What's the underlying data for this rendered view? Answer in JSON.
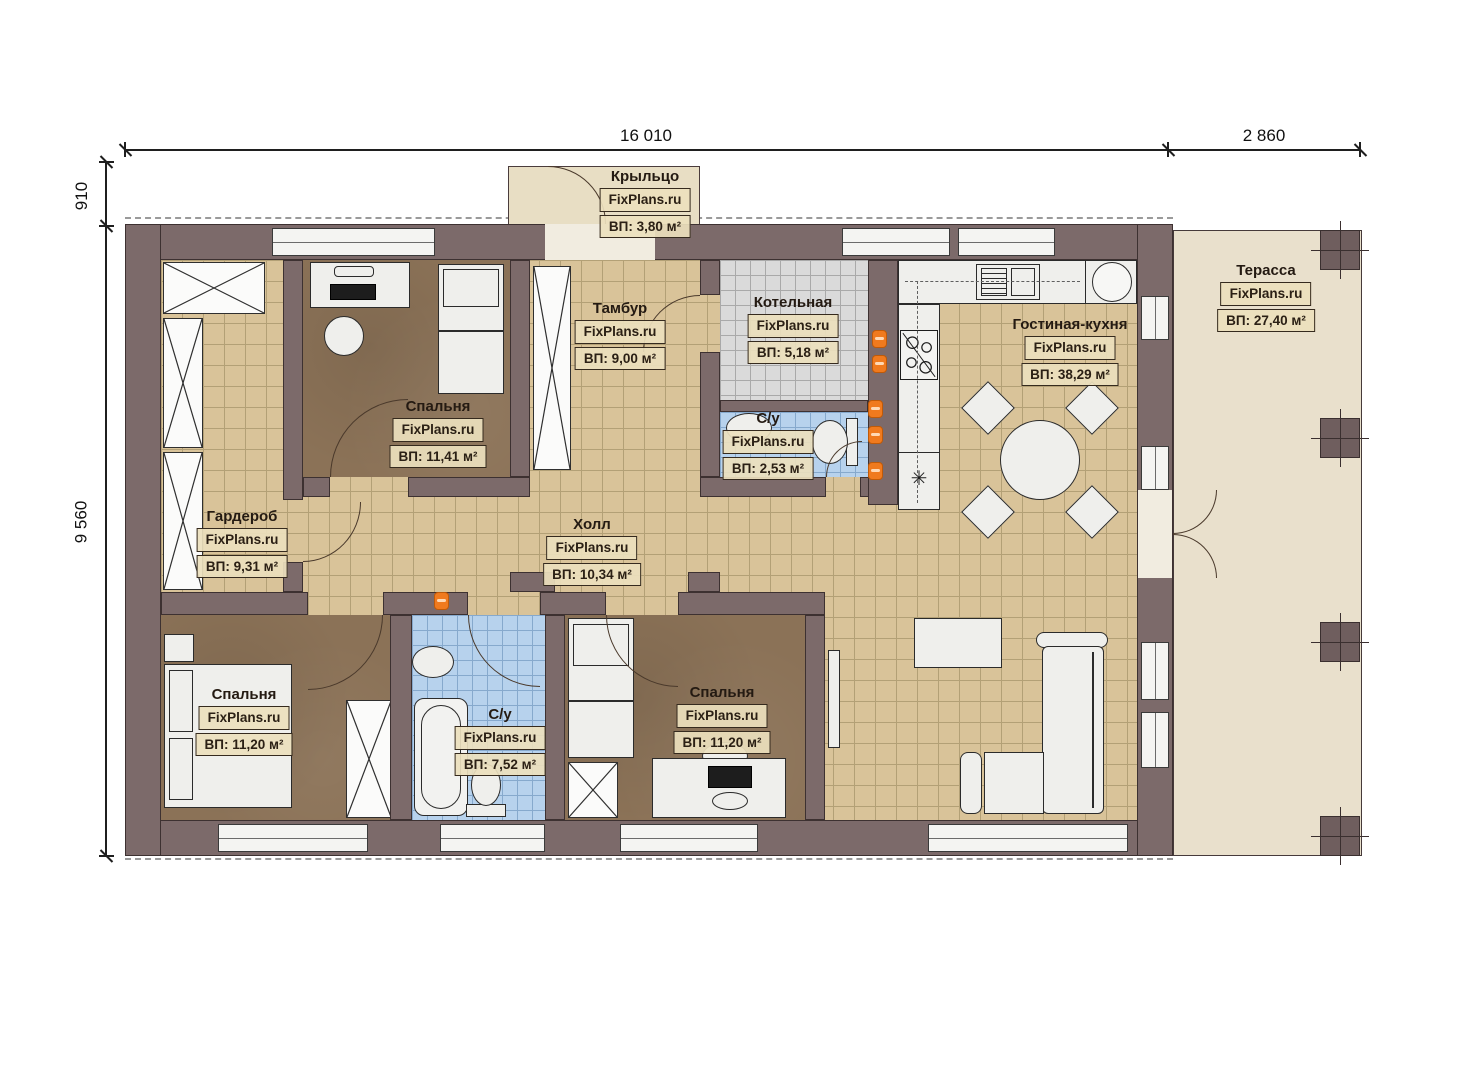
{
  "plan": {
    "watermark": "FixPlans.ru",
    "dimensions": {
      "top_width": "16 010",
      "terrace_width": "2 860",
      "porch_depth": "910",
      "house_depth": "9 560"
    },
    "rooms": [
      {
        "id": "porch",
        "name": "Крыльцо",
        "area": "ВП: 3,80 м²"
      },
      {
        "id": "tambur",
        "name": "Тамбур",
        "area": "ВП: 9,00 м²"
      },
      {
        "id": "boiler",
        "name": "Котельная",
        "area": "ВП: 5,18 м²"
      },
      {
        "id": "wc-top",
        "name": "С/у",
        "area": "ВП: 2,53 м²"
      },
      {
        "id": "living-kitchen",
        "name": "Гостиная-кухня",
        "area": "ВП: 38,29 м²"
      },
      {
        "id": "terrace",
        "name": "Терасса",
        "area": "ВП: 27,40 м²"
      },
      {
        "id": "wardrobe",
        "name": "Гардероб",
        "area": "ВП: 9,31 м²"
      },
      {
        "id": "bedroom-top",
        "name": "Спальня",
        "area": "ВП: 11,41 м²"
      },
      {
        "id": "hall",
        "name": "Холл",
        "area": "ВП: 10,34 м²"
      },
      {
        "id": "bedroom-left",
        "name": "Спальня",
        "area": "ВП: 11,20 м²"
      },
      {
        "id": "wc-bottom",
        "name": "С/у",
        "area": "ВП: 7,52 м²"
      },
      {
        "id": "bedroom-mid",
        "name": "Спальня",
        "area": "ВП: 11,20 м²"
      }
    ],
    "colors": {
      "wall": "#7c6a6a",
      "wall_outline": "#3d3131",
      "floor_tile_tan": "#d9c399",
      "floor_carpet_brown": "#8b7257",
      "floor_tile_blue": "#b7d2ed",
      "floor_tile_gray": "#dadada",
      "terrace": "#e9e0cc",
      "porch": "#e8dec4",
      "fixture_white": "#f1f1ef",
      "heating_orange": "#f07a1e"
    }
  }
}
